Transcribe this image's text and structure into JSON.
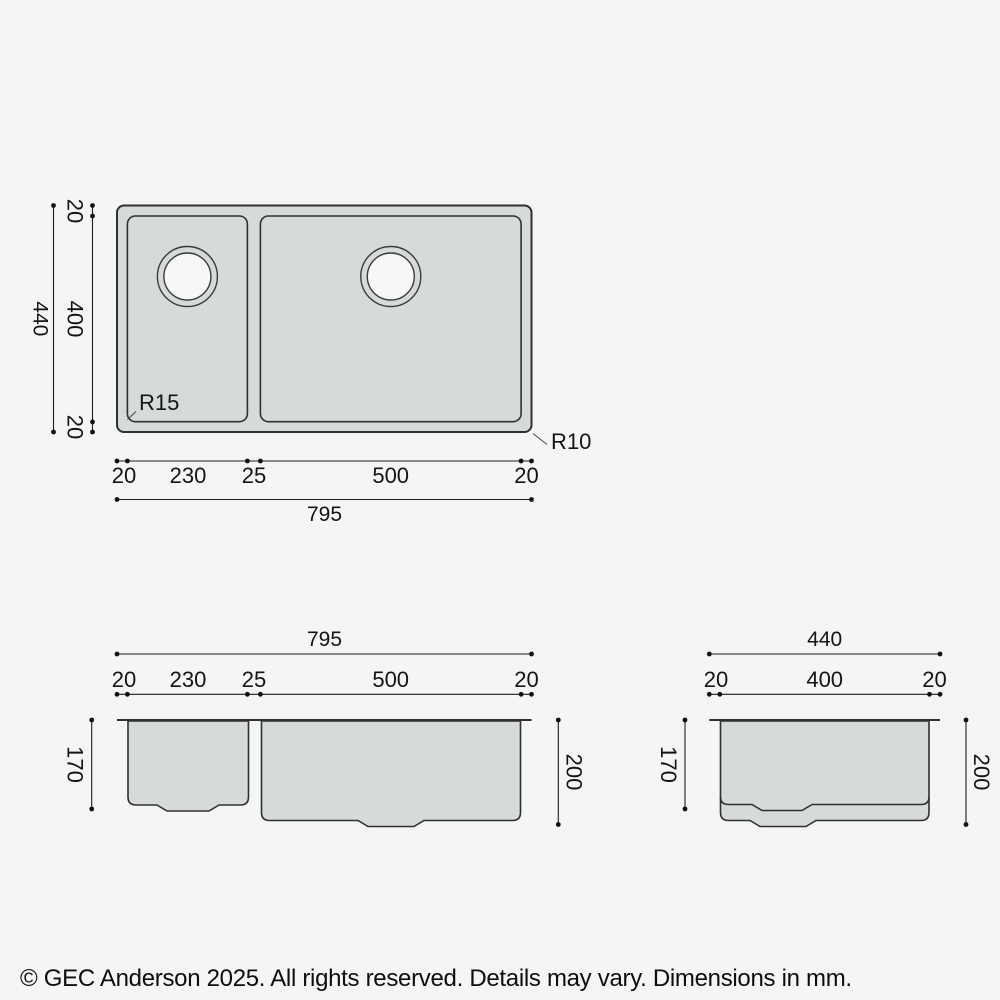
{
  "colors": {
    "background": "#f5f5f3",
    "sink_fill": "#d6dbd8",
    "outline": "#2e312f",
    "dimension": "#1c1c1c"
  },
  "top_view": {
    "height_total": "440",
    "height_segments": [
      "20",
      "400",
      "20"
    ],
    "width_segments": [
      "20",
      "230",
      "25",
      "500",
      "20"
    ],
    "width_total": "795",
    "bowl_corner_radius_label": "R15",
    "outer_corner_radius_label": "R10"
  },
  "front_view": {
    "width_total": "795",
    "width_segments": [
      "20",
      "230",
      "25",
      "500",
      "20"
    ],
    "left_depth": "170",
    "right_depth": "200"
  },
  "side_view": {
    "width_total": "440",
    "width_segments": [
      "20",
      "400",
      "20"
    ],
    "left_depth": "170",
    "right_depth": "200"
  },
  "footer": {
    "copyright": "© GEC Anderson 2025. All rights reserved. Details may vary. Dimensions in mm."
  }
}
